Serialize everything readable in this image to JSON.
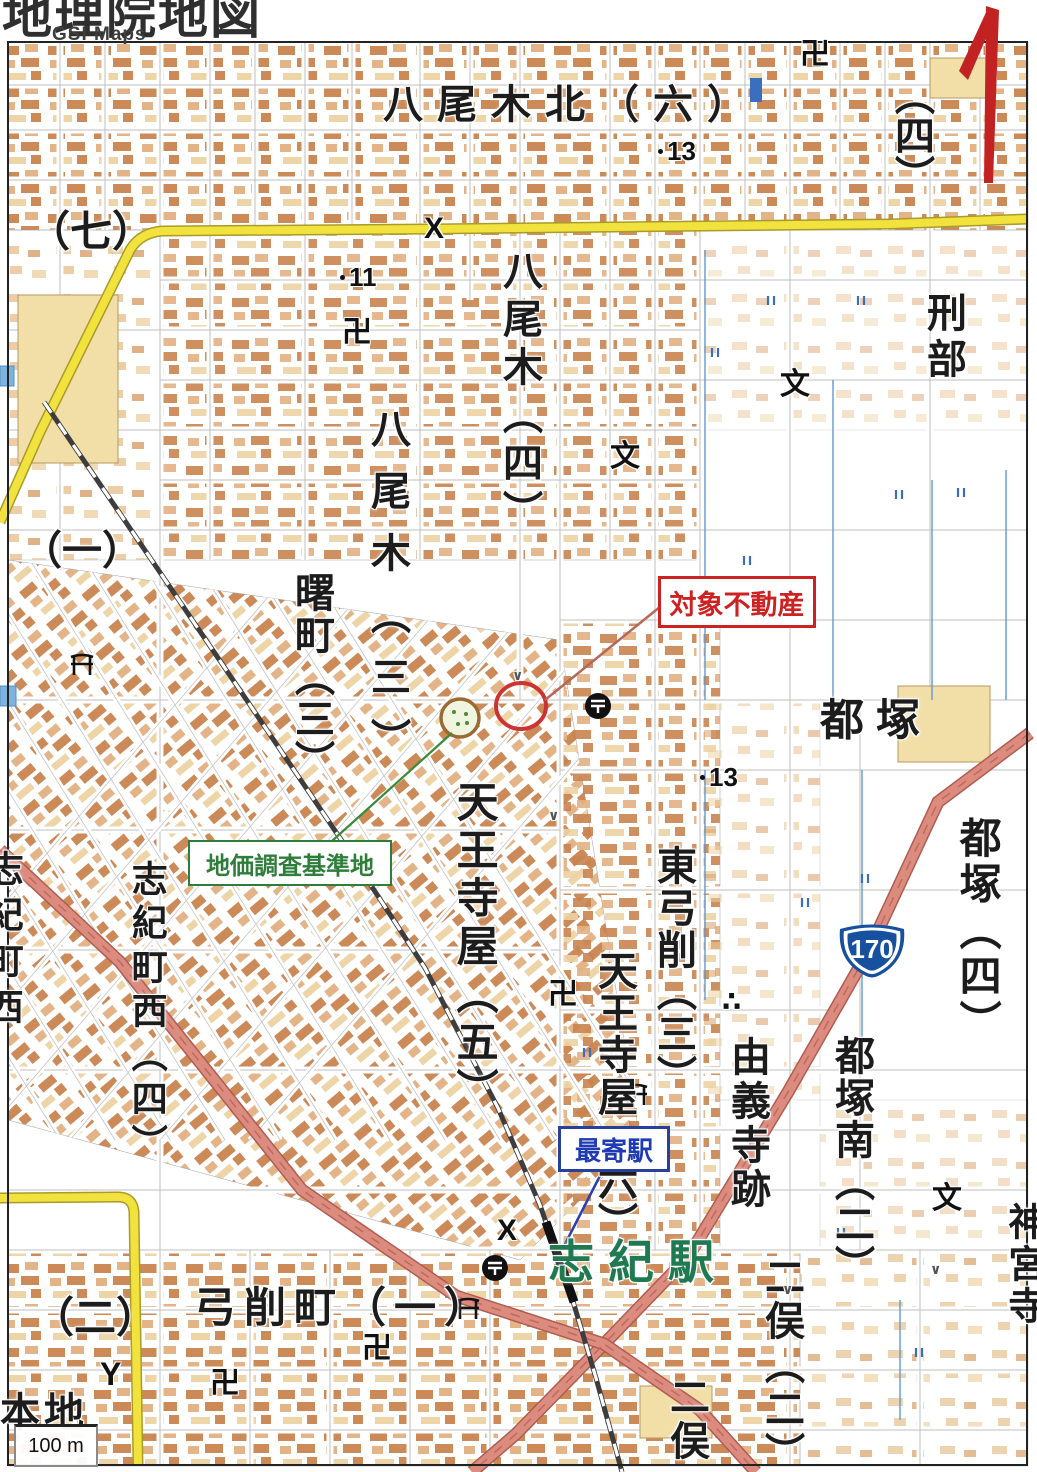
{
  "logo": {
    "title": "地理院地図",
    "subtitle": "GSI Maps"
  },
  "map": {
    "labels": {
      "yaogi_kita": {
        "text": "八尾木北（六）"
      },
      "ku7": {
        "text": "（七）"
      },
      "ku1": {
        "text": "（一）"
      },
      "ku4_topright": {
        "text": "（四）"
      },
      "osakabe": {
        "text": "刑部"
      },
      "yaogi4": {
        "text": "八尾木（四）"
      },
      "yaogi3": {
        "text": "八尾木（三）"
      },
      "akebono3": {
        "text": "曙町（三）"
      },
      "miyakozuka": {
        "text": "都塚"
      },
      "tennojiya5": {
        "text": "天王寺屋（五）"
      },
      "higashi_yuge3": {
        "text": "東弓削（三）"
      },
      "tennojiya6": {
        "text": "天王寺屋（六）"
      },
      "yugidera_ato": {
        "text": "由義寺跡"
      },
      "miyakozuka4": {
        "text": "都塚（四）"
      },
      "miyakozuka_minami2": {
        "text": "都塚南（二）"
      },
      "shikicho_nishi4": {
        "text": "志紀町西（四）"
      },
      "shikicho_nishi_edge": {
        "text": "志紀町西"
      },
      "futamata2": {
        "text": "二俣（二）"
      },
      "futamata_edge": {
        "text": "二俣"
      },
      "jinguji": {
        "text": "神宮寺"
      },
      "yuge_cho1": {
        "text": "弓削町（一）"
      },
      "ku2_bottom": {
        "text": "（二）"
      },
      "honchi": {
        "text": "本地"
      },
      "shiki_station": {
        "text": "志紀駅"
      }
    },
    "callouts": {
      "target_property": {
        "text": "対象不動産"
      },
      "survey_point": {
        "text": "地価調査基準地"
      },
      "nearest_station": {
        "text": "最寄駅"
      }
    },
    "route_shield": {
      "number": "170"
    },
    "spot_elevations": {
      "se1": "13",
      "se2": "11",
      "se3": "13"
    },
    "symbols": {
      "temple": "卍",
      "school": "文",
      "police": "X",
      "fire_station": "Y",
      "historic_site": "∴",
      "field_mark": "∨"
    },
    "scale_label": "100 m"
  },
  "colors": {
    "annotation_red": "#cc2222",
    "annotation_green": "#2e7d3a",
    "annotation_blue": "#27409c",
    "station_name_green": "#1f7a52",
    "road_yellow": "#f2e23e",
    "road_national": "#dc8b7f",
    "shield_blue": "#17509e",
    "north_arrow_red": "#c22222"
  }
}
